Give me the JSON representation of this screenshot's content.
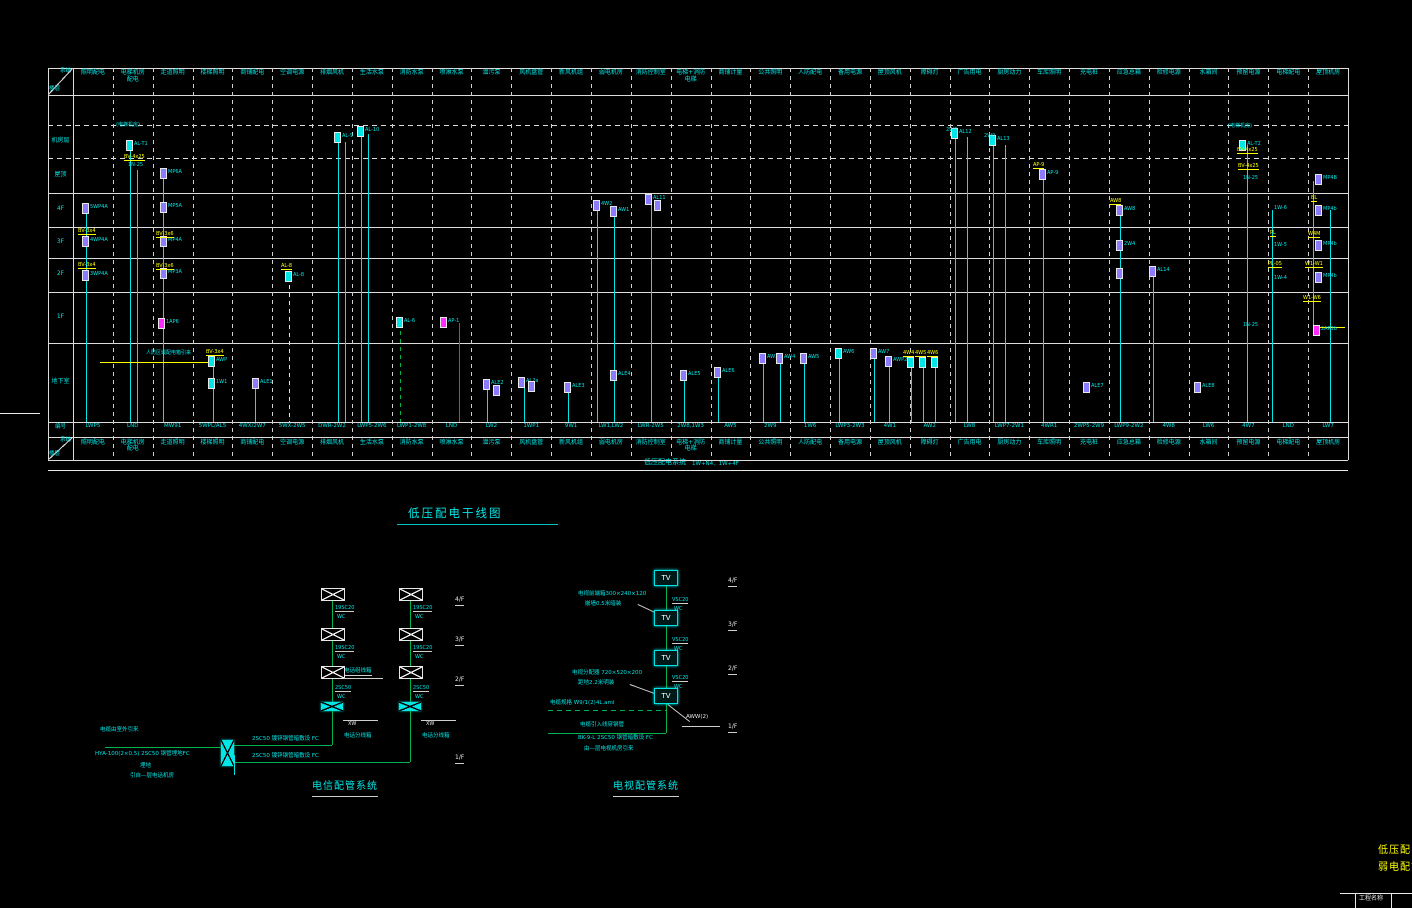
{
  "palette": {
    "cyan": "#00e5e5",
    "green": "#00b34d",
    "yellow": "#ffff00",
    "purple": "#8b7bff",
    "magenta": "#ff2bff",
    "red": "#ff2222",
    "white": "#e8e8e8"
  },
  "main_title": "低压配电干线图",
  "riser_table": {
    "corner_top": "系统",
    "corner_bottom": "楼层",
    "code_row_label": "编号",
    "footer_title": "低压配电系统",
    "footer_note": "1W+N4、1W+4F",
    "floors": [
      "机房层",
      "屋顶",
      "4F",
      "3F",
      "2F",
      "1F",
      "地下室"
    ],
    "columns": [
      {
        "header": "照明配电",
        "code": "LWP5"
      },
      {
        "header": "电梯机房\n配电",
        "code": "LND"
      },
      {
        "header": "走道照明",
        "code": "MW91"
      },
      {
        "header": "楼梯照明",
        "code": "5WPL/AL5"
      },
      {
        "header": "商铺配电",
        "code": "4WX/2W7"
      },
      {
        "header": "空调电源",
        "code": "5WX-2W5"
      },
      {
        "header": "排烟风机",
        "code": "DWR-2W2"
      },
      {
        "header": "生活水泵",
        "code": "LWP5-2W6"
      },
      {
        "header": "消防水泵",
        "code": "LWP1-2W8"
      },
      {
        "header": "喷淋水泵",
        "code": "LND"
      },
      {
        "header": "潜污泵",
        "code": "LW2"
      },
      {
        "header": "风机盘管",
        "code": "1WP1"
      },
      {
        "header": "新风机组",
        "code": "9W1"
      },
      {
        "header": "弱电机房",
        "code": "LW1,LW2"
      },
      {
        "header": "消防控制室",
        "code": "LWR-2W5"
      },
      {
        "header": "电梯+消防\n电梯",
        "code": "2W8,1W3"
      },
      {
        "header": "商铺计量",
        "code": "AW5"
      },
      {
        "header": "公共照明",
        "code": "2W9"
      },
      {
        "header": "人防配电",
        "code": "1W6"
      },
      {
        "header": "备用电源",
        "code": "LWP3-2W3"
      },
      {
        "header": "屋顶风机",
        "code": "4W1"
      },
      {
        "header": "障碍灯",
        "code": "AW2"
      },
      {
        "header": "广告用电",
        "code": "LW8"
      },
      {
        "header": "厨房动力",
        "code": "LWP7-2W1"
      },
      {
        "header": "车库照明",
        "code": "4WR1"
      },
      {
        "header": "充电桩",
        "code": "2WP5-2W9"
      },
      {
        "header": "应急总箱",
        "code": "LWP9-2W2"
      },
      {
        "header": "检修电源",
        "code": "4W8"
      },
      {
        "header": "水箱间",
        "code": "LW6"
      },
      {
        "header": "预留电源",
        "code": "4W7"
      },
      {
        "header": "电梯配电",
        "code": "LND"
      },
      {
        "header": "屋顶机房",
        "code": "LW7"
      }
    ]
  },
  "riser_elements": {
    "lines": [
      [
        86,
        207,
        422,
        "c"
      ],
      [
        130,
        148,
        422,
        "c"
      ],
      [
        137,
        170,
        422,
        "c"
      ],
      [
        163,
        172,
        422,
        "c"
      ],
      [
        213,
        362,
        422,
        "c"
      ],
      [
        255,
        384,
        422,
        "c"
      ],
      [
        289,
        277,
        422,
        "y",
        "d"
      ],
      [
        338,
        138,
        422,
        "c"
      ],
      [
        345,
        142,
        422,
        "c"
      ],
      [
        361,
        130,
        422,
        "c"
      ],
      [
        368,
        134,
        422,
        "c"
      ],
      [
        400,
        323,
        422,
        "g",
        "d"
      ],
      [
        459,
        323,
        422,
        "r"
      ],
      [
        487,
        385,
        422,
        "c"
      ],
      [
        524,
        383,
        422,
        "c"
      ],
      [
        568,
        388,
        422,
        "c"
      ],
      [
        597,
        206,
        422,
        "c"
      ],
      [
        614,
        212,
        422,
        "c"
      ],
      [
        651,
        200,
        422,
        "c"
      ],
      [
        684,
        376,
        422,
        "c"
      ],
      [
        718,
        373,
        422,
        "c"
      ],
      [
        763,
        359,
        422,
        "c"
      ],
      [
        780,
        359,
        422,
        "c"
      ],
      [
        804,
        359,
        422,
        "c"
      ],
      [
        839,
        354,
        422,
        "c"
      ],
      [
        874,
        354,
        422,
        "c"
      ],
      [
        889,
        362,
        422,
        "c"
      ],
      [
        911,
        363,
        422,
        "c"
      ],
      [
        923,
        363,
        422,
        "c"
      ],
      [
        935,
        363,
        422,
        "c"
      ],
      [
        955,
        133,
        422,
        "c"
      ],
      [
        967,
        137,
        422,
        "c"
      ],
      [
        993,
        141,
        422,
        "c"
      ],
      [
        1005,
        145,
        422,
        "c"
      ],
      [
        1043,
        175,
        422,
        "c"
      ],
      [
        1120,
        211,
        422,
        "c"
      ],
      [
        1153,
        272,
        422,
        "c"
      ],
      [
        1247,
        145,
        422,
        "c"
      ],
      [
        1272,
        210,
        422,
        "c"
      ],
      [
        1313,
        181,
        325,
        "c"
      ],
      [
        1330,
        210,
        422,
        "c"
      ]
    ],
    "hlines": [
      [
        100,
        213,
        362,
        "y"
      ],
      [
        1317,
        1345,
        327,
        "y"
      ]
    ],
    "boxes": [
      [
        82,
        203,
        "p",
        "5WP4A"
      ],
      [
        82,
        236,
        "p",
        "4WP4A"
      ],
      [
        82,
        270,
        "p",
        "3WP4A"
      ],
      [
        126,
        140,
        "c",
        "AL-T1"
      ],
      [
        160,
        168,
        "p",
        "MP6A"
      ],
      [
        160,
        202,
        "p",
        "MP5A"
      ],
      [
        160,
        236,
        "p",
        "MP4A"
      ],
      [
        160,
        268,
        "p",
        "MP3A"
      ],
      [
        158,
        318,
        "m",
        "1AP6"
      ],
      [
        208,
        356,
        "c",
        "AWP"
      ],
      [
        208,
        378,
        "c",
        "1W1"
      ],
      [
        252,
        378,
        "p",
        "ALE1"
      ],
      [
        285,
        271,
        "c",
        "AL-8"
      ],
      [
        334,
        132,
        "c",
        "AL-9"
      ],
      [
        357,
        126,
        "c",
        "AL-10"
      ],
      [
        396,
        317,
        "c",
        "AL-6"
      ],
      [
        440,
        317,
        "m",
        "AP-1"
      ],
      [
        483,
        379,
        "p",
        "ALE2"
      ],
      [
        493,
        385,
        "p",
        ""
      ],
      [
        518,
        377,
        "p",
        "AL2a"
      ],
      [
        528,
        381,
        "p",
        ""
      ],
      [
        564,
        382,
        "p",
        "ALE3"
      ],
      [
        593,
        200,
        "p",
        "4W2"
      ],
      [
        610,
        206,
        "p",
        "AW1"
      ],
      [
        610,
        370,
        "p",
        "ALE4"
      ],
      [
        645,
        194,
        "p",
        "AL11"
      ],
      [
        654,
        200,
        "p",
        ""
      ],
      [
        680,
        370,
        "p",
        "ALE5"
      ],
      [
        714,
        367,
        "p",
        "ALE6"
      ],
      [
        759,
        353,
        "p",
        "AW3"
      ],
      [
        776,
        353,
        "p",
        "AW4"
      ],
      [
        800,
        353,
        "p",
        "AW5"
      ],
      [
        835,
        348,
        "c",
        "AW6"
      ],
      [
        870,
        348,
        "p",
        "AW7"
      ],
      [
        885,
        356,
        "p",
        "AWP2"
      ],
      [
        907,
        357,
        "c",
        ""
      ],
      [
        919,
        357,
        "c",
        ""
      ],
      [
        931,
        357,
        "c",
        ""
      ],
      [
        951,
        128,
        "c",
        "AL12"
      ],
      [
        989,
        135,
        "c",
        "AL13"
      ],
      [
        1039,
        169,
        "p",
        "AP-9"
      ],
      [
        1083,
        382,
        "p",
        "ALE7"
      ],
      [
        1116,
        205,
        "p",
        "AW8"
      ],
      [
        1116,
        240,
        "p",
        "2W4"
      ],
      [
        1116,
        268,
        "p",
        ""
      ],
      [
        1149,
        266,
        "p",
        "AL14"
      ],
      [
        1194,
        382,
        "p",
        "ALE8"
      ],
      [
        1239,
        140,
        "c",
        "AL-T2"
      ],
      [
        1315,
        174,
        "p",
        "MP4B"
      ],
      [
        1315,
        205,
        "p",
        "MP4b"
      ],
      [
        1315,
        240,
        "p",
        "MP4b"
      ],
      [
        1315,
        272,
        "p",
        "MP4b"
      ],
      [
        1313,
        325,
        "m",
        "2AP1b"
      ]
    ],
    "ylabels": [
      [
        78,
        229,
        "BV-3x4"
      ],
      [
        78,
        263,
        "BV-3x4"
      ],
      [
        124,
        155,
        "BV-4x25"
      ],
      [
        156,
        232,
        "BV-3x6"
      ],
      [
        156,
        264,
        "BV-3x6"
      ],
      [
        206,
        350,
        "BV-3x4"
      ],
      [
        281,
        264,
        "AL-8"
      ],
      [
        903,
        351,
        "4W4"
      ],
      [
        915,
        351,
        "4W5"
      ],
      [
        927,
        351,
        "4W6"
      ],
      [
        1033,
        163,
        "AP-9"
      ],
      [
        1110,
        199,
        "AW8"
      ],
      [
        1237,
        148,
        "BV-4x25"
      ],
      [
        1238,
        164,
        "BV-4x25"
      ],
      [
        1270,
        231,
        "PL"
      ],
      [
        1268,
        262,
        "PL-05"
      ],
      [
        1311,
        196,
        "BL"
      ],
      [
        1308,
        232,
        "W4M"
      ],
      [
        1305,
        262,
        "W1-W1"
      ],
      [
        1303,
        296,
        "W1-W6"
      ]
    ],
    "clabels": [
      [
        116,
        123,
        "(电梯机房)"
      ],
      [
        1228,
        124,
        "(电梯机房)"
      ],
      [
        128,
        163,
        "1N-25"
      ],
      [
        1243,
        176,
        "1N-25"
      ],
      [
        1274,
        206,
        "1W-6"
      ],
      [
        1274,
        243,
        "1W-5"
      ],
      [
        1274,
        276,
        "1W-4"
      ],
      [
        146,
        351,
        "人防区域配电箱引来"
      ],
      [
        946,
        128,
        "2W6"
      ],
      [
        984,
        134,
        "2W0"
      ],
      [
        1243,
        323,
        "1N-25"
      ]
    ]
  },
  "telecom": {
    "title": "电信配管系统",
    "floors": [
      "4/F",
      "3/F",
      "2/F",
      "1/F"
    ],
    "conduits": [
      [
        "19SC20",
        "WC"
      ],
      [
        "19SC20",
        "WC"
      ],
      [
        "2SC50",
        "WC"
      ]
    ],
    "mid_note": "电话组线箱",
    "dist_box_label": "XW",
    "dist_box_name": "电话分线箱",
    "h_label1": "2SC50 镀锌钢管暗敷设 FC",
    "h_label2": "2SC50 镀锌钢管暗敷设 FC",
    "src1": "电缆由室外引来",
    "src2": "HYA-100(2×0.5) 2SC50 钢管埋地FC",
    "src3": "埋地",
    "src4": "引自—层电话机房"
  },
  "tv": {
    "title": "电视配管系统",
    "floors": [
      "4/F",
      "3/F",
      "2/F",
      "1/F"
    ],
    "box_label": "TV",
    "conduit_a": "VSC20",
    "conduit_b": "WC",
    "note1a": "电视前端箱300×240×120",
    "note1b": "嵌墙0.5米暗装",
    "note2a": "电视分配器 720×520×200",
    "note2b": "距地2.2米明装",
    "cable_label": "电缆规格 W9/1(2)4L.aml",
    "leader_label": "AWW(2)",
    "bottom1": "电缆引入线穿钢管",
    "bottom2": "BK-9-L 2SC50 钢管暗敷设 FC",
    "bottom3": "由—层电视机房引来"
  },
  "corner": {
    "title_line1": "低压配电干",
    "title_line2": "弱电配管系",
    "cell_label": "工程名称"
  }
}
